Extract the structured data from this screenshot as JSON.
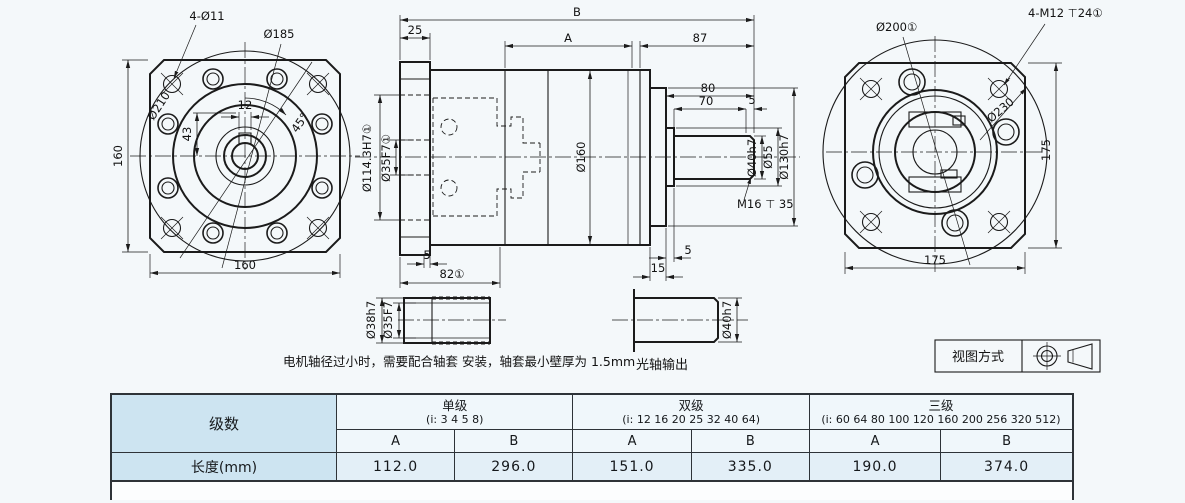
{
  "labels": {
    "front": {
      "corner_holes": "4-Ø11",
      "bolt_circle": "Ø185",
      "outer_circle": "Ø210",
      "keyway_width": "12",
      "keyway_depth": "43",
      "angle": "45°",
      "height": "160",
      "width": "160"
    },
    "section": {
      "overall": "B",
      "flange_len": "25",
      "body_len": "A",
      "rear_len": "87",
      "shaft_total": "80",
      "shaft_len": "70",
      "tip": "5",
      "flange_lip": "5",
      "spigot_gap": "5",
      "flange_depth": "82①",
      "rear_step": "15",
      "body_dia": "Ø160",
      "pilot_dia": "Ø114.3H7①",
      "bore_dia": "Ø35F7①",
      "shaft_dia": "Ø40h7",
      "collar_dia": "Ø55",
      "spigot_dia": "Ø130h7",
      "tap": "M16 ⊤ 35"
    },
    "rear": {
      "pilot": "Ø200①",
      "tapped_holes": "4-M12 ⊤24①",
      "outer_circle": "Ø230",
      "height": "175",
      "width": "175"
    },
    "sleeve": {
      "outer": "Ø38h7",
      "inner": "Ø35F7"
    },
    "shaft_detail": {
      "dia": "Ø40h7",
      "caption": "光轴输出"
    },
    "note": "电机轴径过小时，需要配合轴套 安装，轴套最小壁厚为 1.5mm",
    "projection": {
      "title": "视图方式"
    }
  },
  "table": {
    "stage_header": "级数",
    "row_label": "长度(mm)",
    "col_a": "A",
    "col_b": "B",
    "stages": [
      {
        "name": "单级",
        "ratios": "(i: 3 4 5 8)",
        "a": "112.0",
        "b": "296.0"
      },
      {
        "name": "双级",
        "ratios": "(i: 12 16 20 25 32 40 64)",
        "a": "151.0",
        "b": "335.0"
      },
      {
        "name": "三级",
        "ratios": "(i: 60 64 80 100 120 160 200 256 320 512)",
        "a": "190.0",
        "b": "374.0"
      }
    ]
  }
}
